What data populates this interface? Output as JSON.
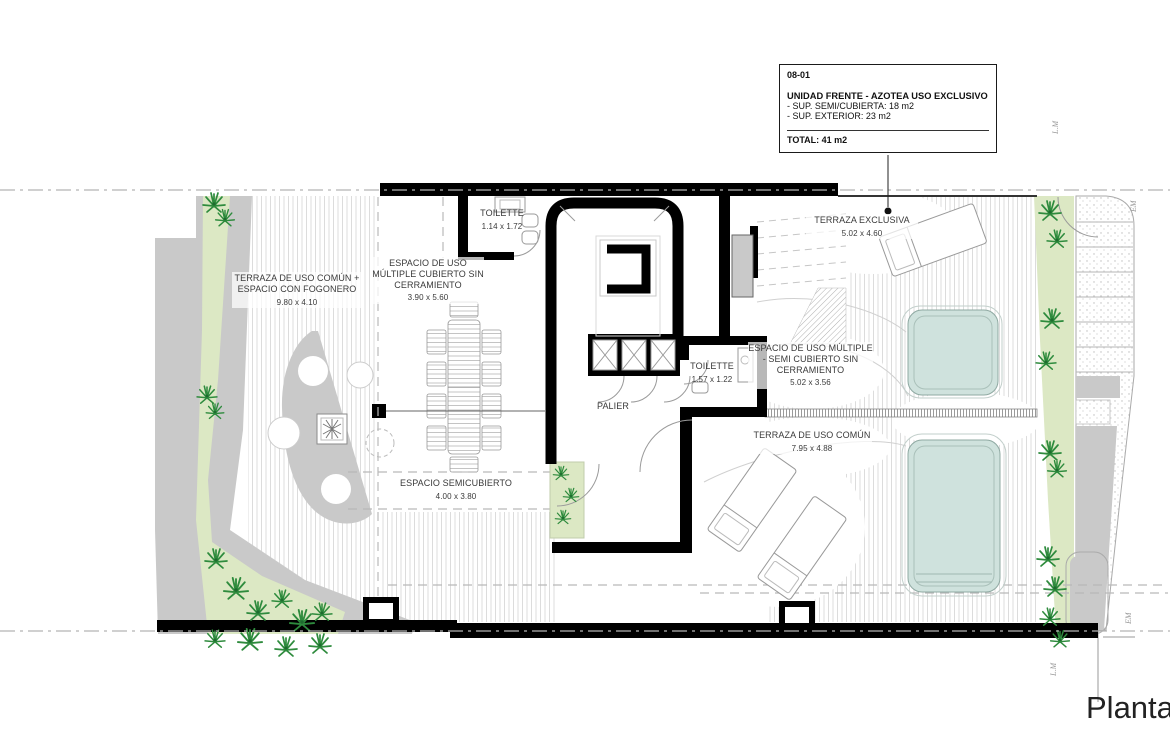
{
  "plan_title": {
    "text": "Planta T"
  },
  "info_box": {
    "code": "08-01",
    "title": "UNIDAD FRENTE - AZOTEA USO EXCLUSIVO",
    "line1": "- SUP. SEMI/CUBIERTA: 18 m2",
    "line2": "- SUP. EXTERIOR: 23 m2",
    "total": "TOTAL: 41 m2"
  },
  "rooms": [
    {
      "name": "TERRAZA DE USO COMÚN + ESPACIO CON FOGONERO",
      "dims": "9.80 x 4.10"
    },
    {
      "name": "ESPACIO DE USO MÚLTIPLE CUBIERTO SIN CERRAMIENTO",
      "dims": "3.90 x 5.60"
    },
    {
      "name": "TOILETTE",
      "dims": "1.14 x 1.72"
    },
    {
      "name": "TERRAZA EXCLUSIVA",
      "dims": "5.02 x 4.60"
    },
    {
      "name": "ESPACIO DE USO MÚLTIPLE - SEMI CUBIERTO SIN CERRAMIENTO",
      "dims": "5.02 x 3.56"
    },
    {
      "name": "TOILETTE",
      "dims": "1.57 x 1.22"
    },
    {
      "name": "PALIER",
      "dims": ""
    },
    {
      "name": "TERRAZA DE USO COMÚN",
      "dims": "7.95 x 4.88"
    },
    {
      "name": "ESPACIO SEMICUBIERTO",
      "dims": "4.00 x 3.80"
    }
  ],
  "edge_labels": [
    {
      "text": "L.M"
    },
    {
      "text": "EM"
    },
    {
      "text": "EM"
    },
    {
      "text": "L.M"
    }
  ],
  "colors": {
    "wall": "#000000",
    "pool_fill": "#cfe2dd",
    "pool_edge": "#8fa9a2",
    "planting_bed": "#dce8c4",
    "palm_green": "#2e8b3d",
    "concrete_grey": "#c9c9c9",
    "label_text": "#3a3a3a"
  }
}
